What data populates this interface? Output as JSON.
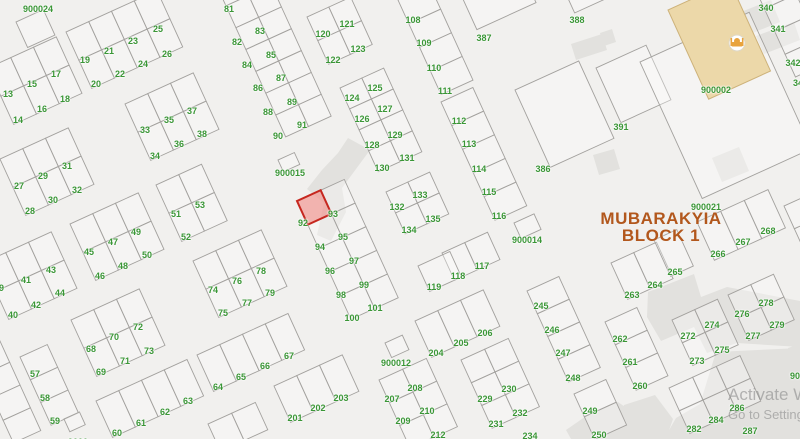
{
  "map": {
    "background_color": "#f1f0ee",
    "parcel_outline_color": "#a3a19e",
    "label_color": "#3a9636",
    "district_title": {
      "line1": "MUBARAKYIA",
      "line2": "BLOCK 1",
      "color": "#b2571c"
    },
    "selected_parcel": {
      "number": "92",
      "fill": "#ef7d77",
      "border": "#c6271f"
    },
    "mosque_parcel": {
      "number": "900002",
      "fill": "#ecd8a9",
      "border": "#cdb27a",
      "icon": "mosque-icon"
    },
    "watermark": {
      "line1": "Activate W",
      "line2": "Go to Settings"
    },
    "labels": [
      [
        "900024",
        38,
        9
      ],
      [
        "13",
        8,
        94
      ],
      [
        "15",
        32,
        84
      ],
      [
        "17",
        56,
        74
      ],
      [
        "14",
        18,
        120
      ],
      [
        "16",
        42,
        109
      ],
      [
        "18",
        65,
        99
      ],
      [
        "19",
        85,
        60
      ],
      [
        "21",
        109,
        51
      ],
      [
        "23",
        133,
        41
      ],
      [
        "25",
        158,
        29
      ],
      [
        "20",
        96,
        84
      ],
      [
        "22",
        120,
        74
      ],
      [
        "24",
        143,
        64
      ],
      [
        "26",
        167,
        54
      ],
      [
        "27",
        19,
        186
      ],
      [
        "29",
        43,
        176
      ],
      [
        "31",
        67,
        166
      ],
      [
        "28",
        30,
        211
      ],
      [
        "30",
        53,
        200
      ],
      [
        "32",
        77,
        190
      ],
      [
        "33",
        145,
        130
      ],
      [
        "35",
        169,
        120
      ],
      [
        "37",
        192,
        111
      ],
      [
        "34",
        155,
        156
      ],
      [
        "36",
        179,
        144
      ],
      [
        "38",
        202,
        134
      ],
      [
        "39",
        -1,
        288
      ],
      [
        "41",
        26,
        280
      ],
      [
        "43",
        51,
        270
      ],
      [
        "40",
        13,
        315
      ],
      [
        "42",
        36,
        305
      ],
      [
        "44",
        60,
        293
      ],
      [
        "45",
        89,
        252
      ],
      [
        "47",
        113,
        242
      ],
      [
        "49",
        136,
        232
      ],
      [
        "46",
        100,
        276
      ],
      [
        "48",
        123,
        266
      ],
      [
        "50",
        147,
        255
      ],
      [
        "51",
        176,
        214
      ],
      [
        "53",
        200,
        205
      ],
      [
        "52",
        186,
        237
      ],
      [
        "57",
        35,
        374
      ],
      [
        "58",
        45,
        398
      ],
      [
        "59",
        55,
        421
      ],
      [
        "60",
        117,
        433
      ],
      [
        "61",
        141,
        423
      ],
      [
        "62",
        165,
        412
      ],
      [
        "63",
        188,
        401
      ],
      [
        "64",
        218,
        387
      ],
      [
        "65",
        241,
        377
      ],
      [
        "66",
        265,
        366
      ],
      [
        "67",
        289,
        356
      ],
      [
        "68",
        91,
        349
      ],
      [
        "70",
        114,
        337
      ],
      [
        "72",
        138,
        327
      ],
      [
        "69",
        101,
        372
      ],
      [
        "71",
        125,
        361
      ],
      [
        "73",
        149,
        351
      ],
      [
        "74",
        213,
        290
      ],
      [
        "76",
        237,
        281
      ],
      [
        "78",
        261,
        271
      ],
      [
        "75",
        223,
        313
      ],
      [
        "77",
        247,
        303
      ],
      [
        "79",
        270,
        293
      ],
      [
        "81",
        229,
        9
      ],
      [
        "82",
        237,
        42
      ],
      [
        "83",
        260,
        31
      ],
      [
        "84",
        247,
        65
      ],
      [
        "85",
        271,
        55
      ],
      [
        "86",
        258,
        88
      ],
      [
        "87",
        281,
        78
      ],
      [
        "88",
        268,
        112
      ],
      [
        "89",
        292,
        102
      ],
      [
        "90",
        278,
        136
      ],
      [
        "91",
        302,
        125
      ],
      [
        "92",
        303,
        223
      ],
      [
        "93",
        333,
        214
      ],
      [
        "94",
        320,
        247
      ],
      [
        "95",
        343,
        237
      ],
      [
        "96",
        330,
        271
      ],
      [
        "97",
        354,
        261
      ],
      [
        "98",
        341,
        295
      ],
      [
        "99",
        364,
        285
      ],
      [
        "100",
        352,
        318
      ],
      [
        "101",
        375,
        308
      ],
      [
        "900015",
        290,
        173
      ],
      [
        "108",
        413,
        20
      ],
      [
        "109",
        424,
        43
      ],
      [
        "110",
        434,
        68
      ],
      [
        "111",
        445,
        91
      ],
      [
        "112",
        459,
        121
      ],
      [
        "113",
        469,
        144
      ],
      [
        "114",
        479,
        169
      ],
      [
        "115",
        489,
        192
      ],
      [
        "116",
        499,
        216
      ],
      [
        "117",
        482,
        266
      ],
      [
        "118",
        458,
        276
      ],
      [
        "119",
        434,
        287
      ],
      [
        "120",
        323,
        34
      ],
      [
        "121",
        347,
        24
      ],
      [
        "122",
        333,
        60
      ],
      [
        "123",
        358,
        49
      ],
      [
        "124",
        352,
        98
      ],
      [
        "125",
        375,
        88
      ],
      [
        "126",
        362,
        119
      ],
      [
        "127",
        385,
        109
      ],
      [
        "128",
        372,
        145
      ],
      [
        "129",
        395,
        135
      ],
      [
        "130",
        382,
        168
      ],
      [
        "131",
        407,
        158
      ],
      [
        "132",
        397,
        207
      ],
      [
        "133",
        420,
        195
      ],
      [
        "134",
        409,
        230
      ],
      [
        "135",
        433,
        219
      ],
      [
        "386",
        543,
        169
      ],
      [
        "387",
        484,
        38
      ],
      [
        "388",
        577,
        20
      ],
      [
        "391",
        621,
        127
      ],
      [
        "900014",
        527,
        240
      ],
      [
        "900002",
        716,
        90
      ],
      [
        "900021",
        706,
        207
      ],
      [
        "340",
        766,
        8
      ],
      [
        "341",
        778,
        29
      ],
      [
        "342",
        793,
        63
      ],
      [
        "34",
        798,
        83
      ],
      [
        "201",
        295,
        418
      ],
      [
        "202",
        318,
        408
      ],
      [
        "203",
        341,
        398
      ],
      [
        "204",
        436,
        353
      ],
      [
        "205",
        461,
        343
      ],
      [
        "206",
        485,
        333
      ],
      [
        "900012",
        396,
        363
      ],
      [
        "207",
        392,
        399
      ],
      [
        "208",
        415,
        388
      ],
      [
        "209",
        403,
        421
      ],
      [
        "210",
        427,
        411
      ],
      [
        "212",
        438,
        435
      ],
      [
        "229",
        485,
        399
      ],
      [
        "230",
        509,
        389
      ],
      [
        "231",
        496,
        424
      ],
      [
        "232",
        520,
        413
      ],
      [
        "234",
        530,
        436
      ],
      [
        "245",
        541,
        306
      ],
      [
        "246",
        552,
        330
      ],
      [
        "247",
        563,
        353
      ],
      [
        "248",
        573,
        378
      ],
      [
        "249",
        590,
        411
      ],
      [
        "250",
        599,
        435
      ],
      [
        "260",
        640,
        386
      ],
      [
        "261",
        630,
        362
      ],
      [
        "262",
        620,
        339
      ],
      [
        "263",
        632,
        295
      ],
      [
        "264",
        655,
        285
      ],
      [
        "265",
        675,
        272
      ],
      [
        "266",
        718,
        254
      ],
      [
        "267",
        743,
        242
      ],
      [
        "268",
        768,
        231
      ],
      [
        "272",
        688,
        336
      ],
      [
        "274",
        712,
        325
      ],
      [
        "273",
        697,
        361
      ],
      [
        "275",
        722,
        350
      ],
      [
        "276",
        742,
        314
      ],
      [
        "277",
        753,
        336
      ],
      [
        "278",
        766,
        303
      ],
      [
        "279",
        777,
        325
      ],
      [
        "282",
        694,
        429
      ],
      [
        "284",
        716,
        420
      ],
      [
        "286",
        737,
        408
      ],
      [
        "287",
        750,
        431
      ],
      [
        "9000",
        800,
        376
      ],
      [
        "9000",
        78,
        442
      ]
    ]
  }
}
